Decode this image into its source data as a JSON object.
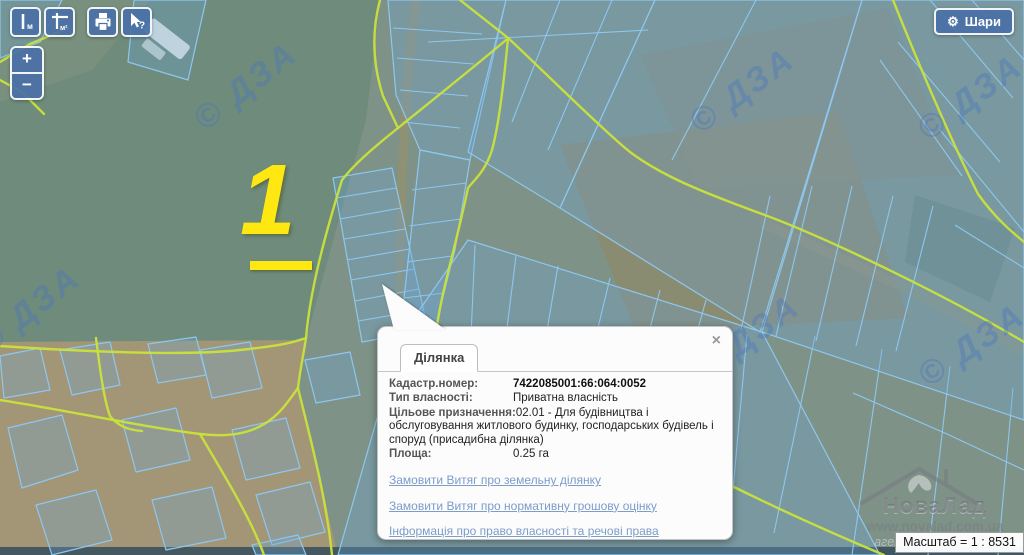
{
  "colors": {
    "steel": "#4a70a6",
    "road": "#c9e23b",
    "parcel_stroke": "#8dc7ef",
    "parcel_fill": "rgba(110,165,215,0.30)",
    "marker": "#ffe812",
    "link": "#7c9cc9",
    "dza": "rgba(70,115,195,0.38)"
  },
  "toolbar": {
    "buttons": [
      {
        "name": "measure-length",
        "label": "м"
      },
      {
        "name": "measure-area",
        "label": "м²"
      },
      {
        "name": "print",
        "label": ""
      },
      {
        "name": "identify-help",
        "label": "?"
      }
    ]
  },
  "zoom_control": {
    "zoom_in": "+",
    "zoom_out": "−"
  },
  "layers_button": {
    "gear_glyph": "⚙",
    "label": "Шари"
  },
  "marker": {
    "label": "1"
  },
  "map": {
    "copyright": "© ДЗА"
  },
  "popup": {
    "tab_label": "Ділянка",
    "close_glyph": "×",
    "fields": [
      {
        "label": "Кадастр.номер:",
        "value": "7422085001:66:064:0052"
      },
      {
        "label": "Тип власності:",
        "value": "Приватна власність"
      },
      {
        "label": "Цільове призначення:",
        "value": "02.01 - Для будівництва і обслуговування житлового будинку, господарських будівель і споруд (присадибна ділянка)"
      },
      {
        "label": "Площа:",
        "value": "0.25 га"
      }
    ],
    "links": [
      "Замовити Витяг про земельну ділянку",
      "Замовити Витяг про нормативну грошову оцінку",
      "Інформація про право власності та речові права"
    ]
  },
  "brand_watermark": {
    "name": "НоваЛад",
    "url": "www.novalad.com.ua",
    "tagline": "агенція нерухомості"
  },
  "scale_bar": {
    "label": "Масштаб = 1 : 8531"
  }
}
